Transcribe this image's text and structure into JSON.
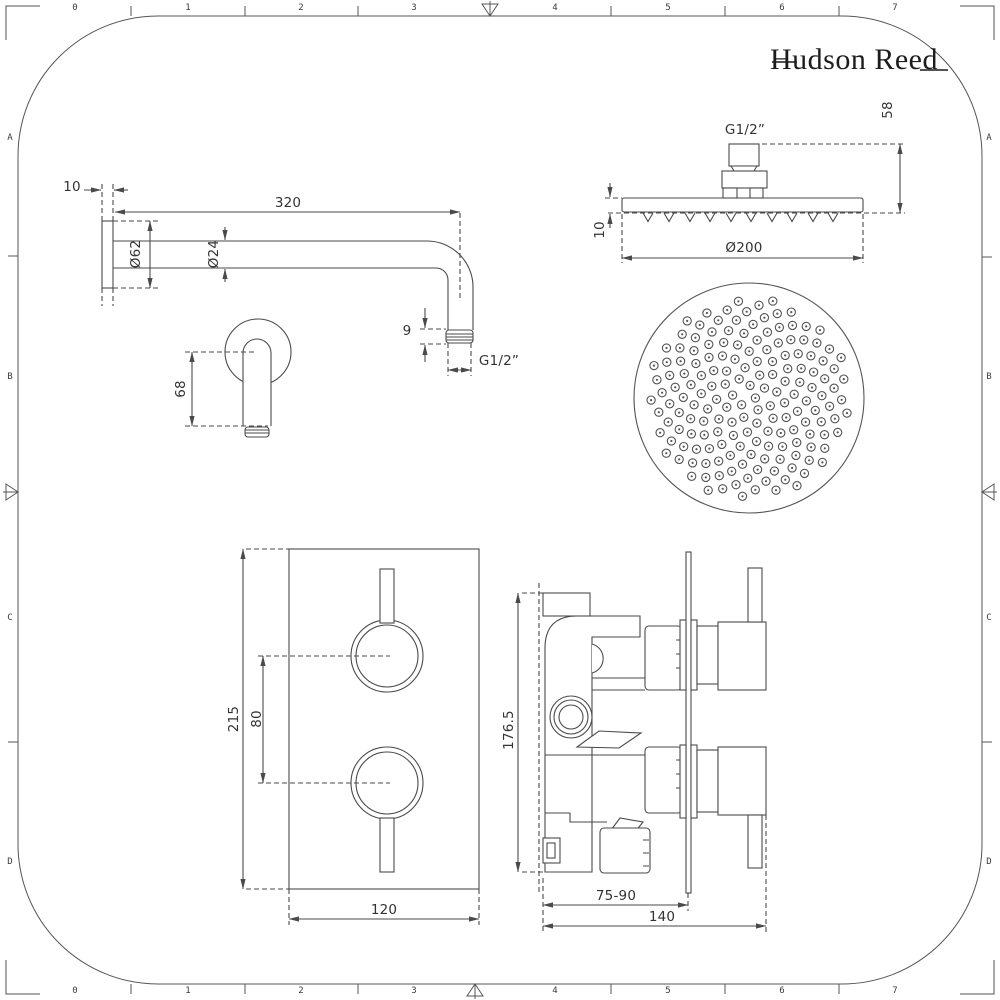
{
  "brand": {
    "name": "Hudson Reed"
  },
  "frame": {
    "top_labels": [
      "0",
      "1",
      "2",
      "3",
      "4",
      "5",
      "6",
      "7"
    ],
    "bottom_labels": [
      "0",
      "1",
      "2",
      "3",
      "4",
      "5",
      "6",
      "7"
    ],
    "left_labels": [
      "A",
      "B",
      "C",
      "D"
    ],
    "right_labels": [
      "A",
      "B",
      "C",
      "D"
    ]
  },
  "drawings": {
    "shower_arm": {
      "labels": {
        "wall_offset": "10",
        "length": "320",
        "flange_dia": "Ø62",
        "arm_dia": "Ø24",
        "thread_len": "9",
        "thread": "G1/2”"
      }
    },
    "wall_outlet": {
      "labels": {
        "height": "68"
      }
    },
    "shower_head_side": {
      "labels": {
        "thread": "G1/2”",
        "connector_height": "58",
        "head_thickness": "10",
        "head_dia": "Ø200"
      }
    },
    "valve_front": {
      "labels": {
        "plate_height": "215",
        "knob_spacing": "80",
        "plate_width": "120"
      }
    },
    "valve_side": {
      "labels": {
        "body_height": "176.5",
        "wall_depth_range": "75-90",
        "total_depth": "140"
      }
    }
  },
  "colors": {
    "line": "#4a4a4a",
    "text": "#333333"
  }
}
